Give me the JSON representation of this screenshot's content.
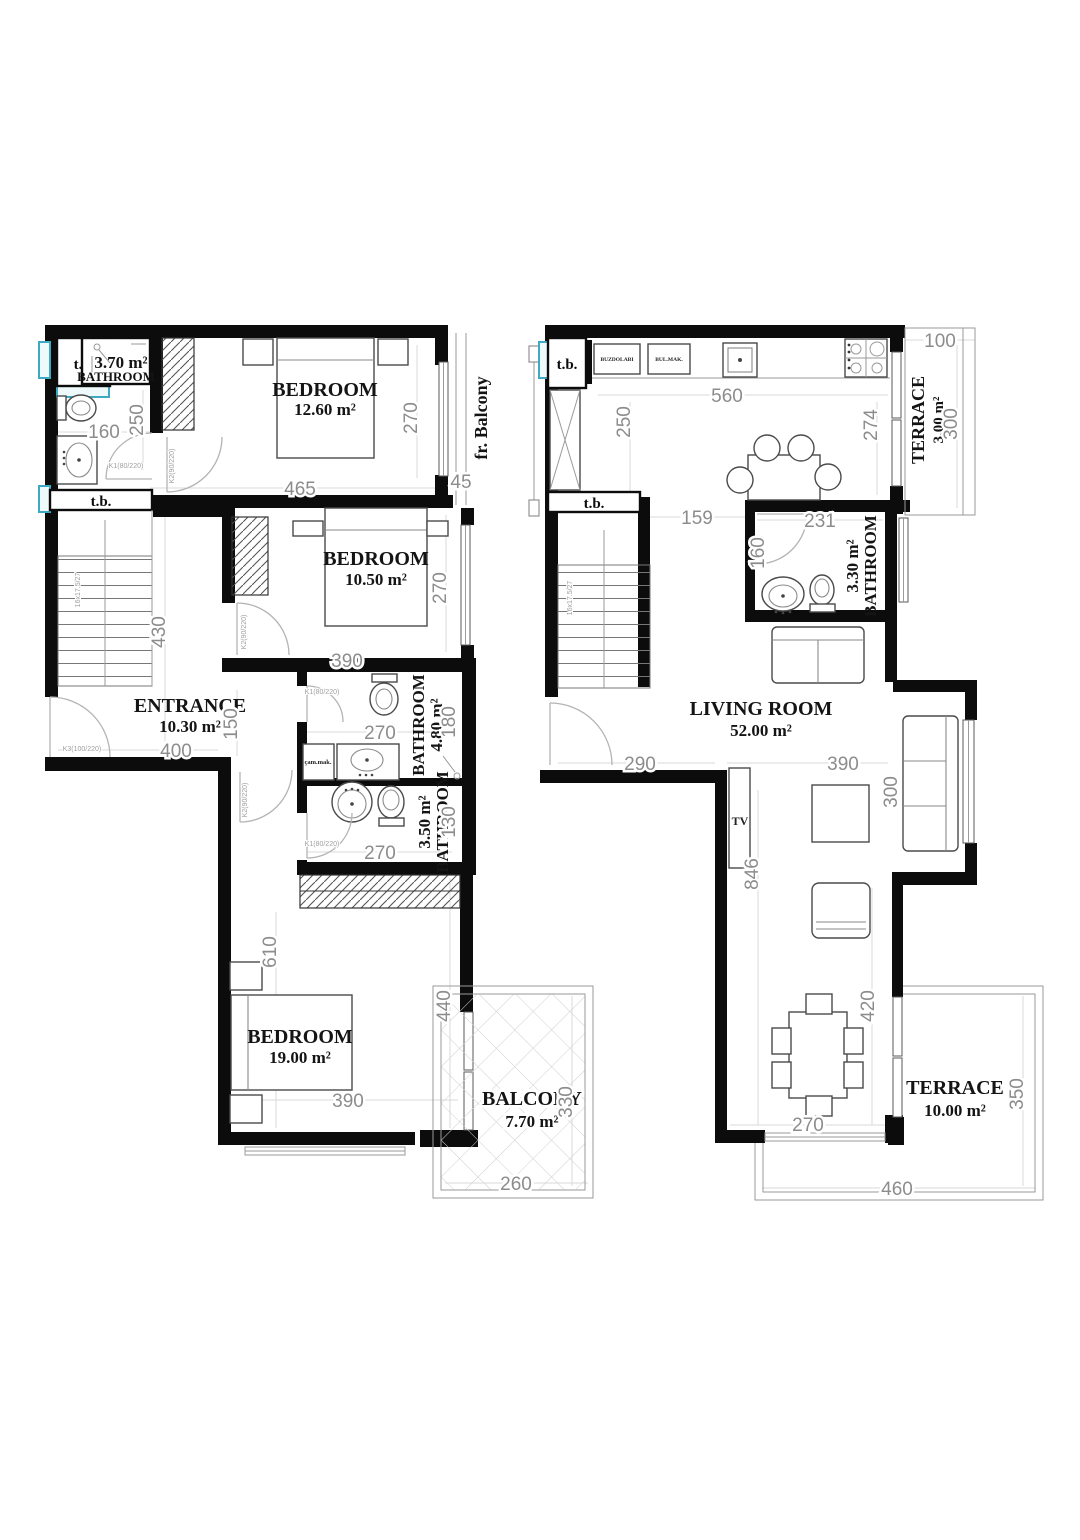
{
  "colors": {
    "wall": "#0c0c0c",
    "dimension_text": "#8c8c8c",
    "window_accent": "#3fa8c2"
  },
  "f1": {
    "tb1": "t.b.",
    "tb2": "t.b.",
    "bath1_area": "3.70 m²",
    "bath1_name": "BATHROOM",
    "bed1_name": "BEDROOM",
    "bed1_area": "12.60 m²",
    "frbalcony": "fr. Balcony",
    "bed2_name": "BEDROOM",
    "bed2_area": "10.50 m²",
    "ent_name": "ENTRANCE",
    "ent_area": "10.30 m²",
    "bath2_area": "4.80 m²",
    "bath2_name": "BATHROOM",
    "bath3_area": "3.50 m²",
    "bath3_name": "BATHROOM",
    "bed3_name": "BEDROOM",
    "bed3_area": "19.00 m²",
    "balc_name": "BALCONY",
    "balc_area": "7.70 m²",
    "wash": "çam.mak.",
    "stair": "16x17.5/27",
    "k1": "K1(80/220)",
    "k2": "K2(90/220)",
    "k3": "K3(100/220)",
    "d160": "160",
    "d250": "250",
    "d270bed1": "270",
    "d465": "465",
    "d45": "45",
    "d390bed2": "390",
    "d270bed2": "270",
    "d430": "430",
    "d150": "150",
    "d400": "400",
    "d270bath2": "270",
    "d180": "180",
    "d270bath3": "270",
    "d130": "130",
    "d610": "610",
    "d390bed3": "390",
    "d440": "440",
    "d330": "330",
    "d260": "260"
  },
  "f2": {
    "tb1": "t.b.",
    "tb2": "t.b.",
    "fridge": "BUZDOLABI",
    "dwash": "BUL.MAK.",
    "terr1_name": "TERRACE",
    "terr1_area": "3.00 m²",
    "bath_area": "3.30 m²",
    "bath_name": "BATHROOM",
    "liv_name": "LIVING ROOM",
    "liv_area": "52.00 m²",
    "tv": "TV",
    "terr2_name": "TERRACE",
    "terr2_area": "10.00 m²",
    "stair": "16x17.5/27",
    "d100": "100",
    "d300terr": "300",
    "d560": "560",
    "d250": "250",
    "d274": "274",
    "d159": "159",
    "d231": "231",
    "d160": "160",
    "d290": "290",
    "d390": "390",
    "d300": "300",
    "d846": "846",
    "d420": "420",
    "d270": "270",
    "d350": "350",
    "d460": "460"
  }
}
